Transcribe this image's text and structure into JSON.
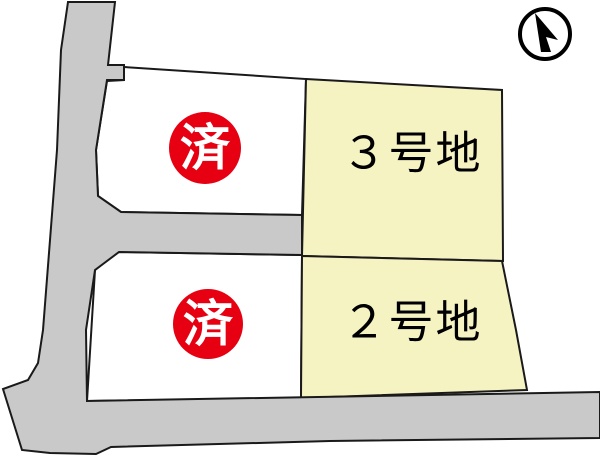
{
  "colors": {
    "background": "#ffffff",
    "road_fill": "#c9c9c9",
    "plot_available_fill": "#f6f3c3",
    "plot_sold_fill": "#ffffff",
    "outline": "#1a1a1a",
    "sold_badge_fill": "#e60012",
    "sold_badge_text": "#ffffff",
    "label_text": "#000000",
    "compass": "#000000"
  },
  "plots": {
    "plot3": {
      "label": "３号地"
    },
    "plot2": {
      "label": "２号地"
    },
    "sold_upper": {
      "badge": "済"
    },
    "sold_lower": {
      "badge": "済"
    }
  }
}
